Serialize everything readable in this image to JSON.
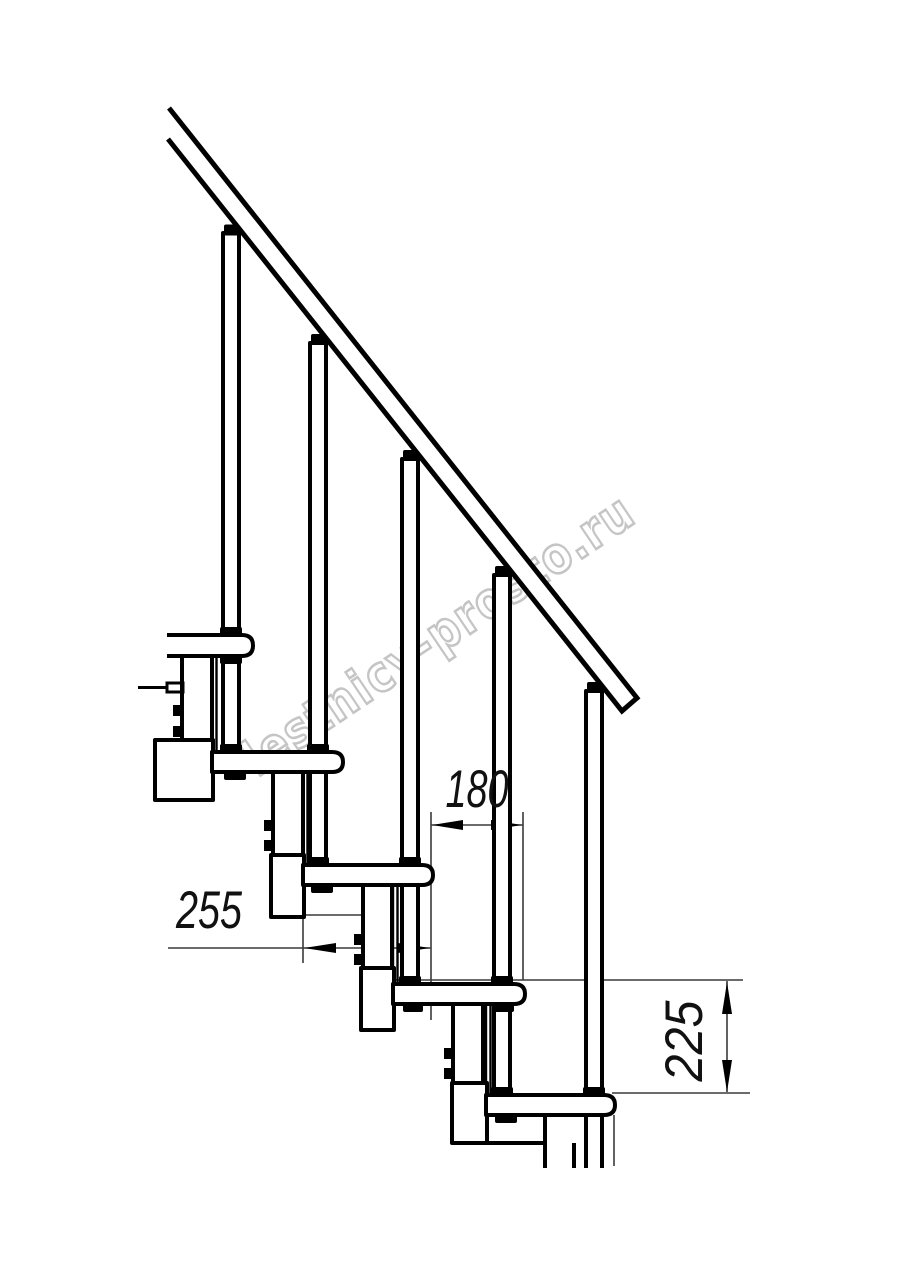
{
  "drawing": {
    "title": "modular-staircase-side-view",
    "dimensions": {
      "step_run": "180",
      "tread_depth": "255",
      "riser_height": "225"
    },
    "watermark": "lestnicy-prosto.ru",
    "colors": {
      "line": "#000000",
      "dimension_line": "#3a3a3a",
      "watermark": "#c5c5c5",
      "background": "#ffffff"
    }
  }
}
